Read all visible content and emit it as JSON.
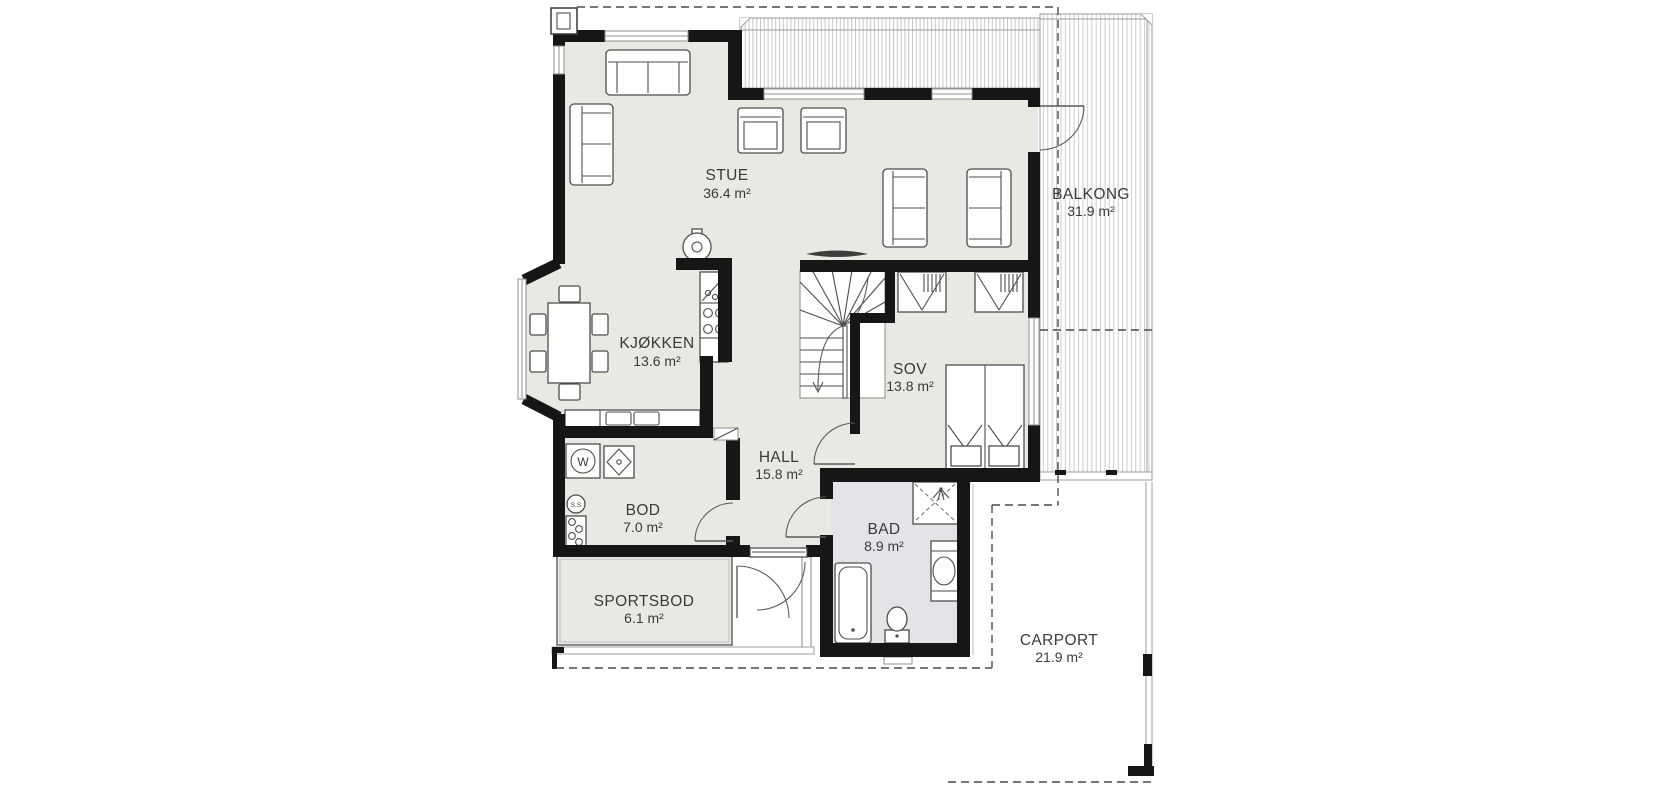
{
  "plan": {
    "rooms": {
      "stue": {
        "name": "STUE",
        "area": "36.4 m²"
      },
      "kjokken": {
        "name": "KJØKKEN",
        "area": "13.6 m²"
      },
      "sov": {
        "name": "SOV",
        "area": "13.8 m²"
      },
      "hall": {
        "name": "HALL",
        "area": "15.8 m²"
      },
      "bod": {
        "name": "BOD",
        "area": "7.0 m²"
      },
      "sportsbod": {
        "name": "SPORTSBOD",
        "area": "6.1 m²"
      },
      "bad": {
        "name": "BAD",
        "area": "8.9 m²"
      },
      "balkong": {
        "name": "BALKONG",
        "area": "31.9 m²"
      },
      "carport": {
        "name": "CARPORT",
        "area": "21.9 m²"
      }
    },
    "appliance_labels": {
      "washer": "W",
      "floor_drain": "S.S"
    },
    "colors": {
      "wall": "#161616",
      "floor": "#e9e8e2",
      "bath_floor": "#e2e4e8",
      "deck_hatch": "#c9cdd0",
      "text": "#3a3a3a"
    }
  }
}
